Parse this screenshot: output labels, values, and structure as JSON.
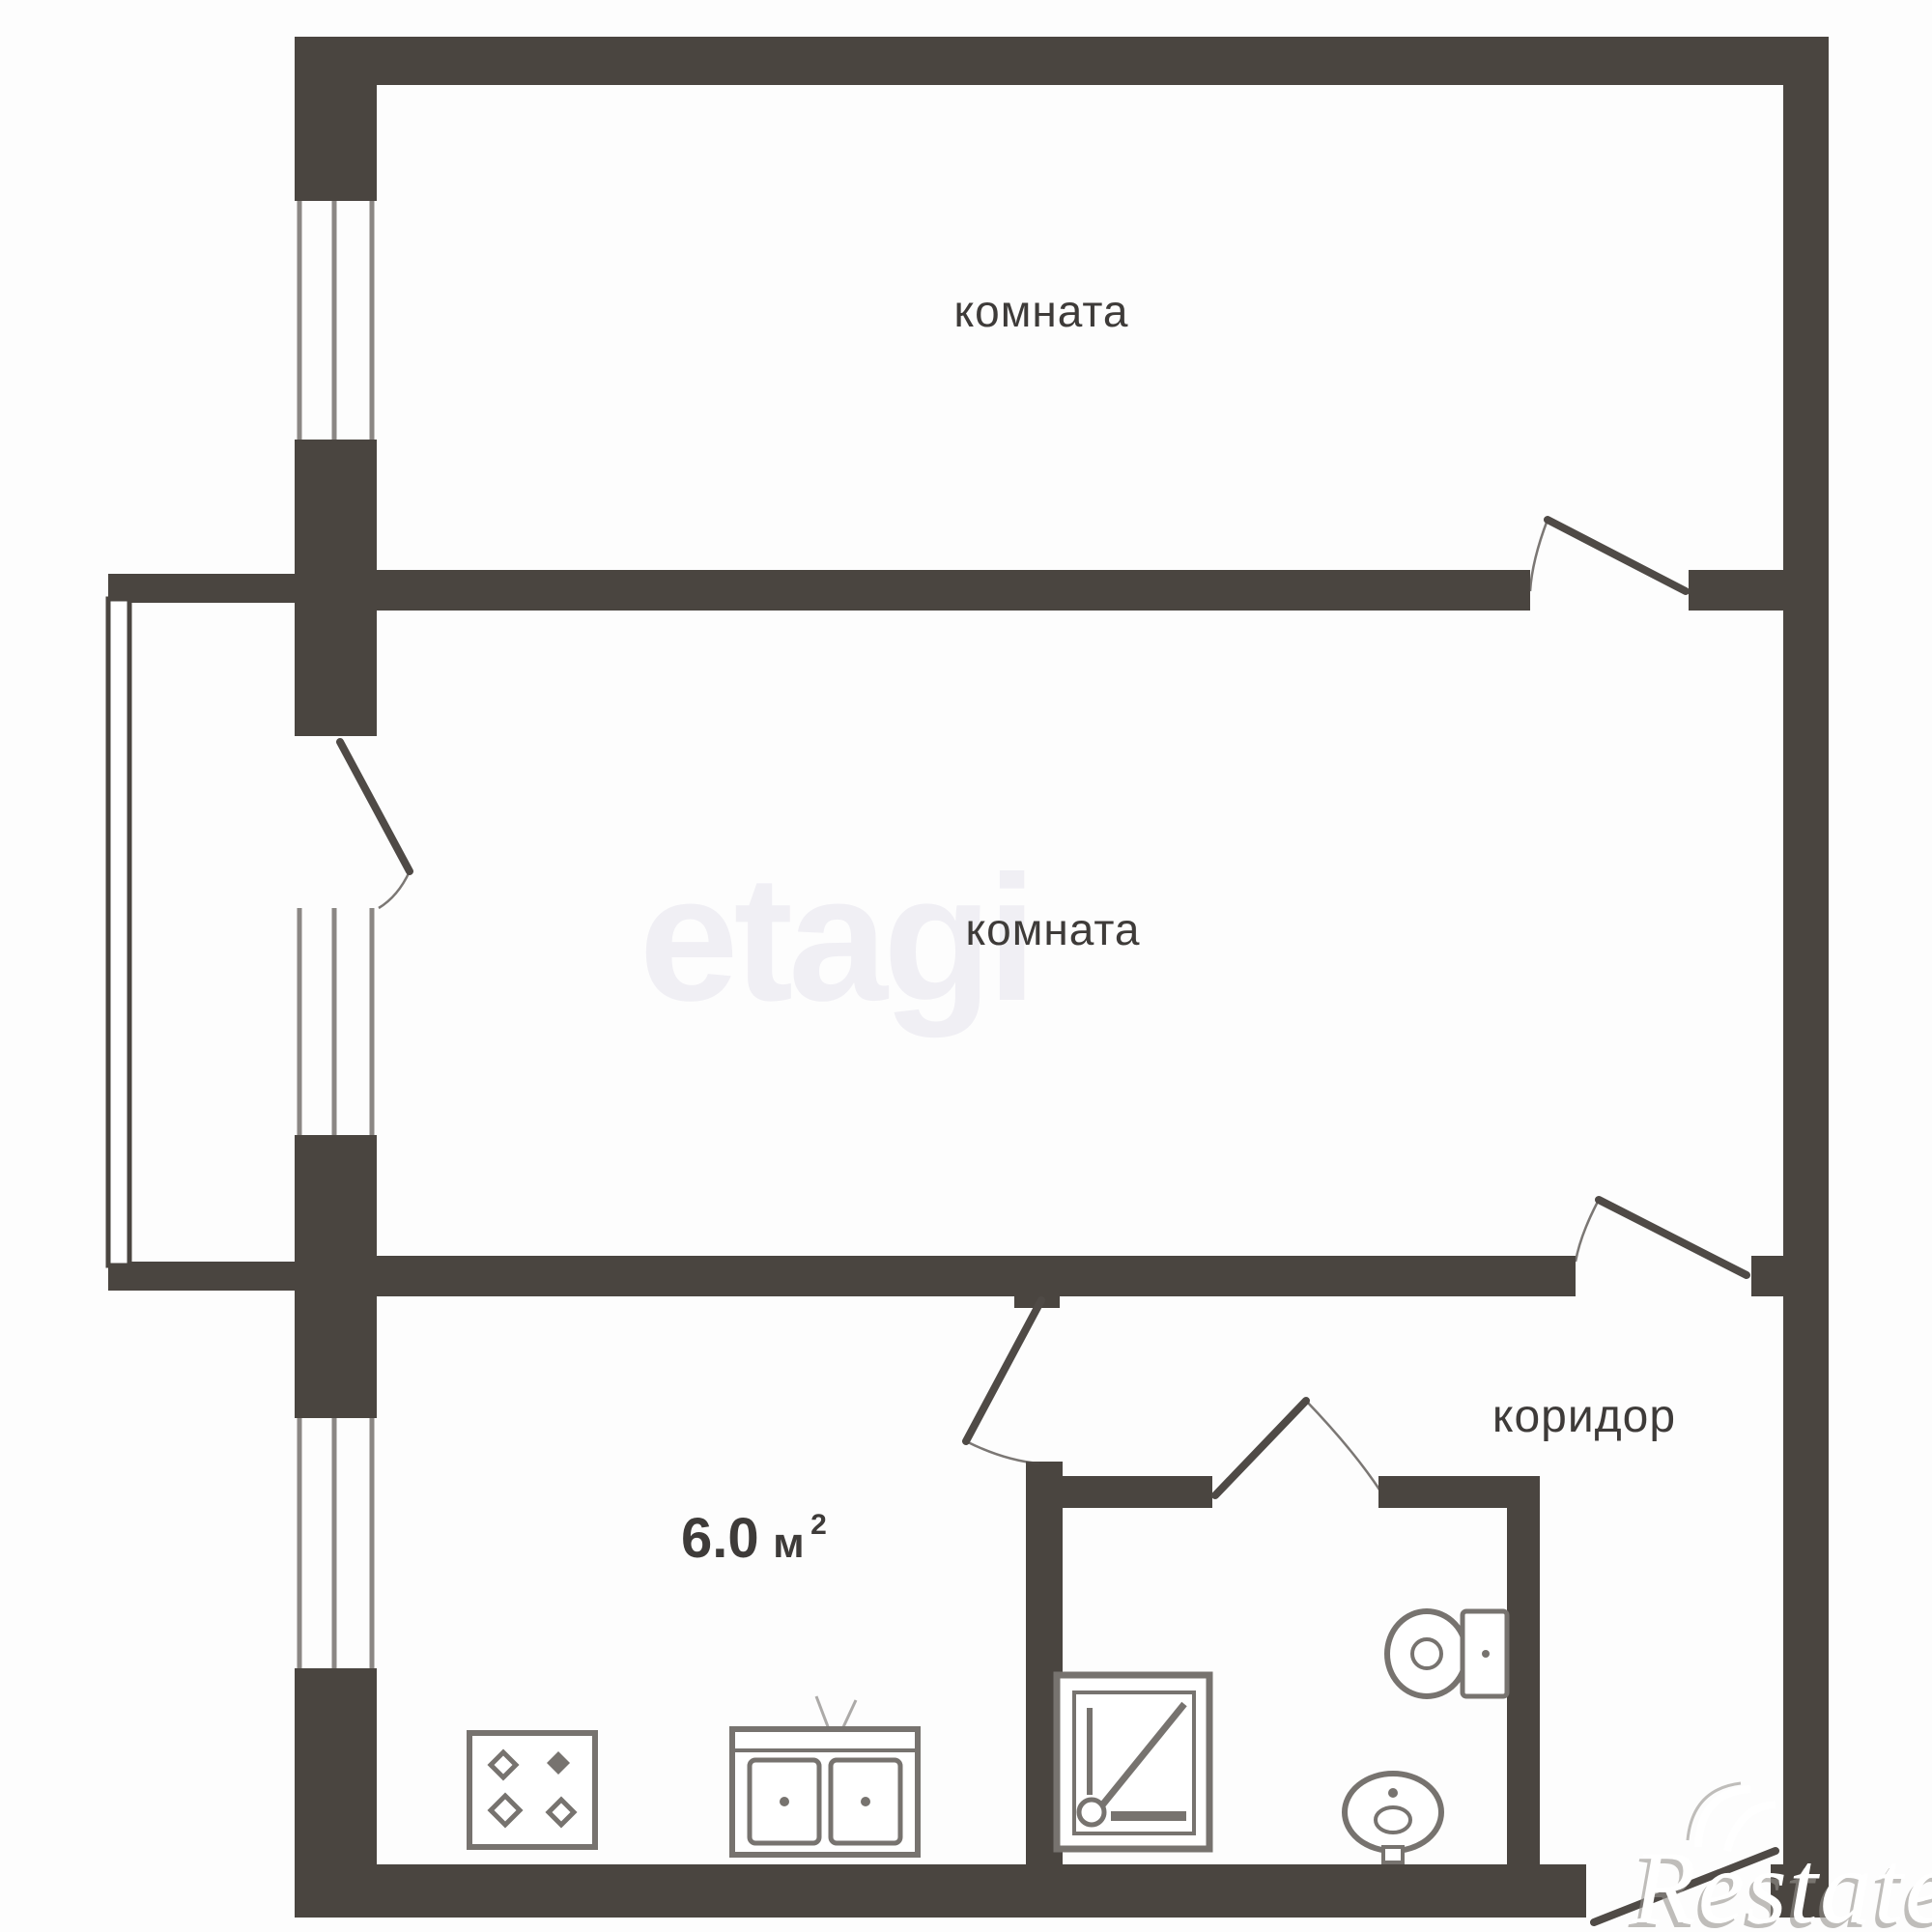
{
  "title": "2-room apartment floor plan",
  "colors": {
    "bg": "#fdfdfd",
    "wall": "#4a4540",
    "door_line": "#4f4a46",
    "glazing": "#8b8784",
    "fixture": "#77736f",
    "text": "#3e3b39",
    "watermark_etagi": "#d4d1e2",
    "watermark_restate": "#ffffff",
    "watermark_restate_shadow": "#96938e"
  },
  "rooms": {
    "room_top": {
      "label": "комната"
    },
    "room_middle": {
      "label": "комната"
    },
    "corridor": {
      "label": "коридор"
    },
    "kitchen": {
      "area_value": "6.0",
      "area_unit": "м",
      "area_sup": "2"
    }
  },
  "fixtures": {
    "shower": "shower-tray",
    "toilet": "toilet",
    "wash_basin": "wash-basin",
    "stove": "stove-4-burner",
    "kitchen_sink": "double-bowl-sink"
  },
  "watermarks": {
    "etagi": "etagi",
    "restate": "Restate"
  }
}
